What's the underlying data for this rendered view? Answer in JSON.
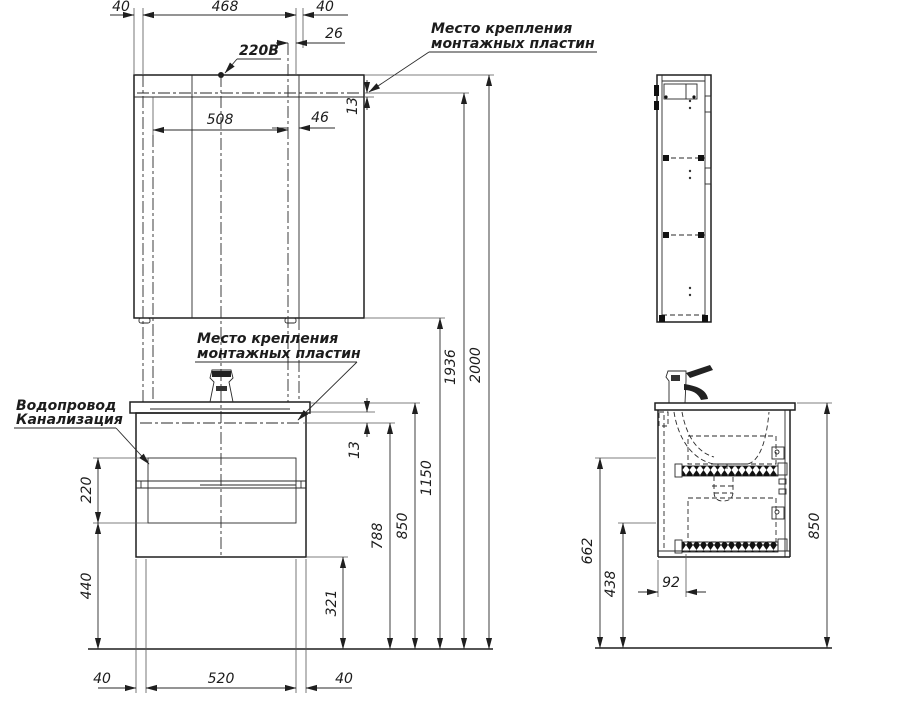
{
  "drawing": {
    "callouts": {
      "voltage": "220В",
      "mount_top": {
        "line1": "Место крепления",
        "line2": "монтажных пластин"
      },
      "mount_mid": {
        "line1": "Место крепления",
        "line2": "монтажных пластин"
      },
      "plumbing": {
        "line1": "Водопровод",
        "line2": "Канализация"
      }
    },
    "front": {
      "top": {
        "left_offset": "40",
        "span": "468",
        "right_offset": "40",
        "plate_offset": "26",
        "plate_span": "508",
        "plate_side": "46",
        "plate_depth": "13"
      },
      "left": {
        "hatch_height": "220",
        "hatch_bottom": "440"
      },
      "bottom": {
        "left_offset": "40",
        "span": "520",
        "right_offset": "40"
      },
      "right": {
        "cabinet_bottom": "321",
        "vanity_plate": "788",
        "counter_height": "850",
        "mirror_bottom": "1150",
        "mirror_plate": "1936",
        "total_height": "2000",
        "vanity_plate_depth": "13"
      }
    },
    "side": {
      "slide_upper": "662",
      "slide_lower": "438",
      "drain_offset": "92",
      "counter_height": "850"
    }
  }
}
